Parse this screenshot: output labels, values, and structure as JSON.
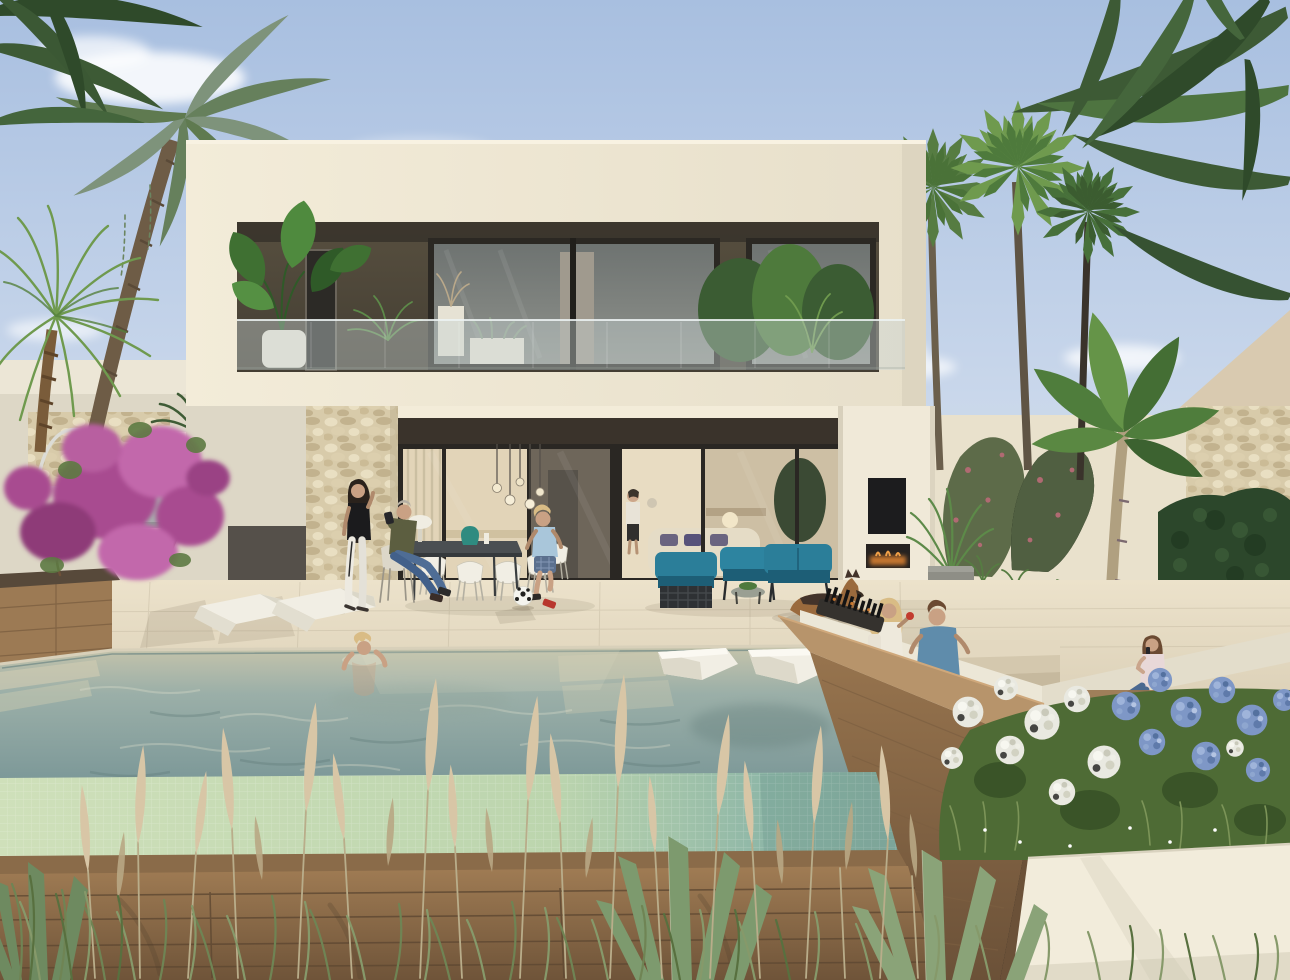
{
  "meta": {
    "title": "Modern luxury villa with infinity pool - architectural rendering",
    "type": "photorealistic 3D exterior visualization, no on-screen text",
    "time_of_day": "late afternoon, warm sunlight from the right",
    "description": "Two-storey white modern villa with cantilevered upper floor, dark recessed balcony with glass railing and potted plants, open ground-floor glass wall with warm interior, stone-clad pillar, outdoor dining with family, teal lounge set, German shepherd dog, tropical garden with fan palms and banana plants, sunken wooden lounge with fire feature and seating, infinity pool with two floating loungers and a bathing woman, two white sun loungers, purple bougainvillea, white and blue hydrangeas, wooden deck and pampas grass in the foreground"
  },
  "palette": {
    "sky_top": "#a8bfe0",
    "sky_mid": "#c9d7eb",
    "sky_low": "#e4e6df",
    "wall_sun": "#f3ecd9",
    "wall_cream": "#e9e1cc",
    "wall_shade": "#ddd7c6",
    "wall_grey": "#a9afae",
    "recess": "#4b453b",
    "recess_dark": "#37322a",
    "fascia": "#3a332b",
    "glass_a": "#6e7371",
    "glass_b": "#8f928c",
    "stone": "#d8cbaa",
    "stone_lt": "#e9dfc2",
    "stone_dk": "#c2b28e",
    "int_warm": "#e2d4b8",
    "int_dim": "#6e665a",
    "int_bright": "#e8dcc2",
    "teal": "#2b7e99",
    "teal_dk": "#1d5e76",
    "woven": "#2e3134",
    "terrace": "#e9dfc7",
    "terrace_dk": "#d9cfb7",
    "water_top": "#c6c4ab",
    "water_mid": "#9bafa8",
    "water_dp": "#7c9898",
    "tile_lt": "#cfe0ba",
    "tile_sh": "#8fb7a7",
    "wood_lt": "#b7946b",
    "wood_md": "#97744e",
    "wood_dk": "#6b5138",
    "deck": "#a07c54",
    "deck_dk": "#6f5439",
    "cushion": "#ece7d7",
    "hedge": "#2c472b",
    "grn_dk": "#3d5a35",
    "grn_md": "#567c42",
    "grn_br": "#6f9a4e",
    "grn_gy": "#7e937b",
    "banana": "#4f7d3c",
    "boug": "#a84b90",
    "boug_lt": "#c268ab",
    "hyd_w": "#e9e9e1",
    "hyd_b": "#7e97c6",
    "pampas": "#d8c6a6",
    "pampas_dk": "#b9a884",
    "grass": "#7c9458",
    "agave": "#7d9a6e",
    "skin": "#c9a184",
    "hair_dk": "#2a221c",
    "hair_bl": "#d9bc85",
    "hair_br": "#6b4a32",
    "white_furn": "#f1eee4",
    "jeans": "#4f6d95",
    "olive": "#5c5e40",
    "shirt_lb": "#a9c6da",
    "fire": "#e08432",
    "dog": "#9a6a3d",
    "dog_dk": "#43332a",
    "tv": "#1c1c1e",
    "planter_w": "#f2ecdb",
    "vase": "#2f8b80"
  },
  "scene": {
    "objects": [
      {
        "name": "villa",
        "desc": "white modern two-storey house, cantilevered upper box, dark recessed balcony, glass balustrade"
      },
      {
        "name": "balcony-plants",
        "desc": "alocasia in white pot, small palms, white planter boxes, bushy plants right"
      },
      {
        "name": "ground-glass-wall",
        "desc": "full-height sliding glass, warm lit interior, curtains, pendant globes, cream sofa, kitchen"
      },
      {
        "name": "stone-pillar",
        "desc": "beige rubble-stone clad pillar left of glass wall"
      },
      {
        "name": "white-pillar",
        "desc": "right pillar with wall TV and linear fireplace"
      },
      {
        "name": "outdoor-dining",
        "desc": "dark table, teal vase, white mushroom lamp, light shell chairs"
      },
      {
        "name": "teal-lounge",
        "desc": "three teal seats with dark woven base, round table with succulents"
      },
      {
        "name": "sunken-lounge",
        "desc": "wood-clad pit with white cushions, fire trough with black sticks, steps"
      },
      {
        "name": "pool",
        "desc": "infinity pool, green mosaic tile face, two white floating loungers, underwater steps"
      },
      {
        "name": "sun-loungers",
        "desc": "two sculptural white chaises on travertine terrace"
      },
      {
        "name": "garden-right",
        "desc": "banana plant, areca palm, grey cube planter, white round pots, clipped hedge, climbing vines"
      },
      {
        "name": "garden-left",
        "desc": "purple bougainvillea over wooden planter, cycad in white box, ferns, arc lamp"
      },
      {
        "name": "foreground",
        "desc": "wooden deck, white planter wall, hydrangeas, pampas grass, agaves"
      },
      {
        "name": "palms",
        "desc": "large date palm left, pygmy palm foreground left, three fan palms right, arching fronds top right"
      }
    ]
  },
  "people": [
    {
      "id": "standing-woman",
      "desc": "dark-haired woman, black top, white track pants with black stripe, standing by stone pillar"
    },
    {
      "id": "seated-man",
      "desc": "man in olive sweater and jeans seated on chair, taking a photo"
    },
    {
      "id": "boy",
      "desc": "blond boy, light blue t-shirt, plaid shorts, one red sneaker, playing with soccer ball"
    },
    {
      "id": "pool-woman",
      "desc": "blonde woman relaxing in the pool, arms behind head"
    },
    {
      "id": "interior-woman",
      "desc": "woman in white blouse and black skirt seen through glass"
    },
    {
      "id": "pit-woman",
      "desc": "blonde woman in white top with toddler, holding red apple, sunken lounge"
    },
    {
      "id": "pit-man",
      "desc": "man in blue t-shirt seen from behind, sunken lounge"
    },
    {
      "id": "phone-woman",
      "desc": "woman in pale top and jeans talking on phone, sunken lounge"
    }
  ],
  "animals": [
    {
      "id": "dog",
      "desc": "German shepherd lying on the terrace near the teal lounge"
    }
  ],
  "counts": {
    "people": 8,
    "sun_loungers": 2,
    "in_pool_loungers": 2,
    "teal_seats": 3,
    "fan_palms": 3,
    "white_pots": 3
  }
}
